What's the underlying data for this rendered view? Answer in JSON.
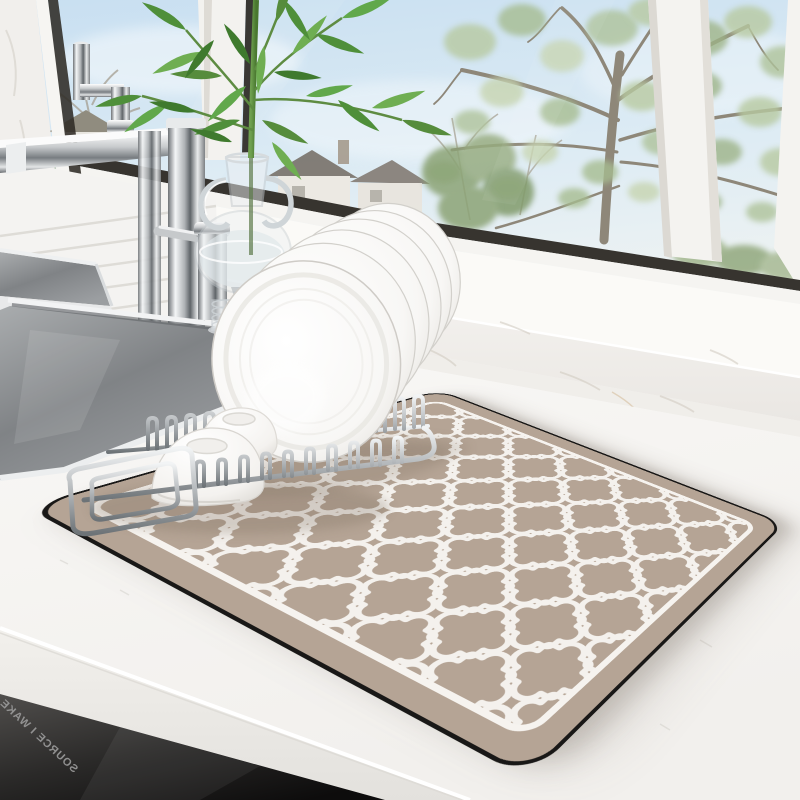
{
  "scene": {
    "description": "Kitchen product photo: taupe stone drying mat with white Moroccan trellis pattern on a white marble counter, chrome dish rack holding white plates and bowls, tall chrome faucet with soap dispenser, stainless double sink, glass vase with green palm stems, bright window with spring tree view",
    "watermark": {
      "text": "SOURCE I WAKE"
    },
    "objects": [
      "window-view",
      "tree",
      "houses",
      "window-frame",
      "marble-sill",
      "kitchen-faucet",
      "soap-dispenser",
      "kitchen-sink",
      "glass-vase",
      "green-plant",
      "drying-mat",
      "dish-rack",
      "plates",
      "bowls",
      "countertop",
      "cabinet-front",
      "watermark"
    ],
    "palette": {
      "mat": "#b5a495",
      "mat_pattern": "#f4f1ed",
      "mat_edge": "#191817",
      "counter": "#f7f6f4",
      "cabinet_dark": "#141312",
      "sky": "#cbe0f1",
      "tree_foliage": "#aec29a",
      "plant_green": "#4f8f3a",
      "chrome": "#b9bdc0",
      "dishes": "#fcfcfb",
      "seal_line": "#37342f"
    }
  }
}
